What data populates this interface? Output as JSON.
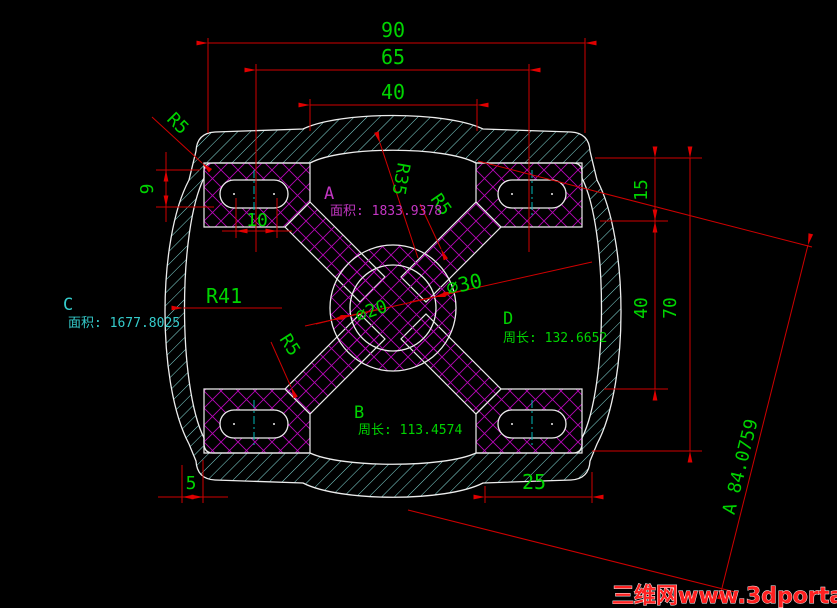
{
  "app": {
    "type": "cad-drawing-viewport",
    "background": "#000000"
  },
  "colors": {
    "outline_white": "#ededed",
    "dimension_red": "#cf0000",
    "dimension_text_green": "#00d400",
    "hatch_cyan": "#84dcd8",
    "crosshatch_magenta": "#b507b5",
    "label_magenta": "#c436c4",
    "label_cyan": "#35cccc",
    "centerline_cyan": "#00b8b8",
    "watermark_red": "#ff2020"
  },
  "dims": {
    "w90": "90",
    "w65": "65",
    "w40": "40",
    "h9": "9",
    "w10": "10",
    "r15": "15",
    "r40": "40",
    "r70": "70",
    "b5": "5",
    "b25": "25",
    "diag": "A 84.0759",
    "r5_topleft": "R5",
    "r35": "R35",
    "r5_a": "R5",
    "r5_c": "R5",
    "r41": "R41",
    "dia20": "⌀20",
    "dia30": "⌀30"
  },
  "regions": {
    "a": {
      "label": "A",
      "info": "面积: 1833.9378"
    },
    "b": {
      "label": "B",
      "info": "周长: 113.4574"
    },
    "c": {
      "label": "C",
      "info": "面积: 1677.8025"
    },
    "d": {
      "label": "D",
      "info": "周长: 132.6652"
    }
  },
  "watermark": {
    "text": "三维网www.3dportal.cn"
  }
}
